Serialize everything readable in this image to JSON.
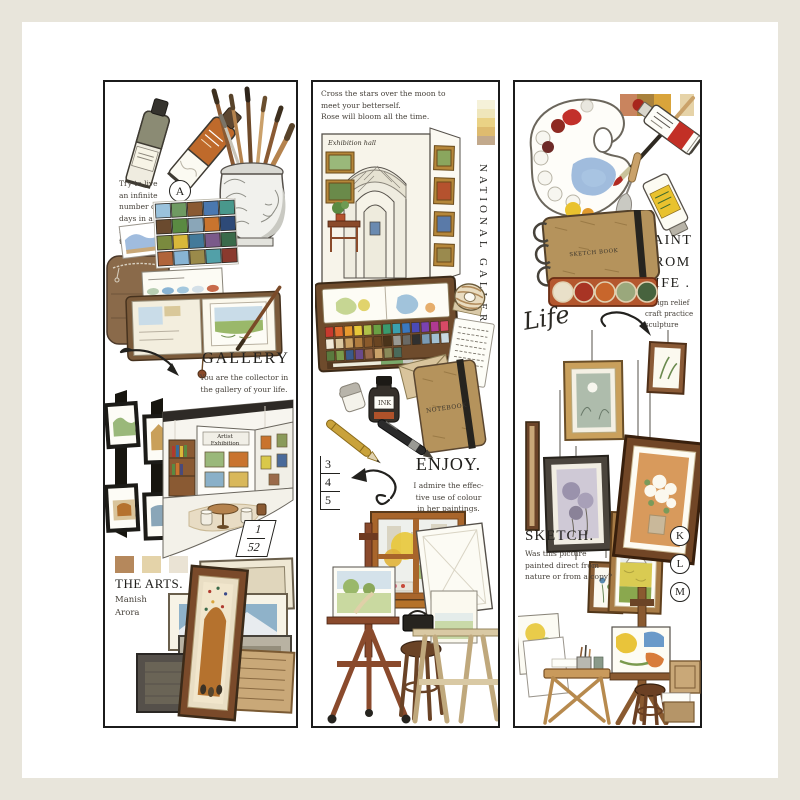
{
  "page": {
    "background": "#e8e5db",
    "card": "#ffffff"
  },
  "panel_left": {
    "quote": "Try to live\nan infinite\nnumber of\ndays in a\nlimited\ntime.",
    "badge": "A",
    "gallery": {
      "title": "GALLERY",
      "caption": "You are the collector in\nthe gallery of your life.",
      "exhibition_sign": "Artist Exhibition"
    },
    "fraction": {
      "numerator": "1",
      "denominator": "52"
    },
    "swatches": [
      "#b5885c",
      "#e4d3a9",
      "#eae3d4"
    ],
    "arts": {
      "title": "THE ARTS.",
      "author": "Manish\nArora"
    }
  },
  "panel_middle": {
    "quote": "Cross the stars over the moon to\nmeet your betterself.\nRose will bloom all the time.",
    "swatch_strip": [
      "#f5f1d9",
      "#efe6bb",
      "#ead285",
      "#debb6f",
      "#c2a98c"
    ],
    "hall_label": "Exhibition hall",
    "vertical_title": "NATIONAL GALLERY",
    "notebook_label": "NOTEBOOK",
    "ink_label": "INK",
    "list_numbers": [
      "3",
      "4",
      "5"
    ],
    "enjoy": {
      "title": "ENJOY.",
      "caption": "I admire the effec-\ntive use of colour\nin her paintings."
    }
  },
  "panel_right": {
    "swatch_bar": [
      "#c9845e",
      "#a8813c",
      "#d9a43b"
    ],
    "swatch_single": "#e6d3a8",
    "sketchbook_label": "SKETCH BOOK",
    "paint": {
      "title": "PAINT\nFROM\nLIFE .",
      "caption": "design relief\ncraft practice\nsculpture"
    },
    "life_script": "Life",
    "sketch": {
      "title": "SKETCH.",
      "caption": "Was this picture\npainted direct from\nnature or from a copy?"
    },
    "badges": [
      "K",
      "L",
      "M"
    ]
  }
}
